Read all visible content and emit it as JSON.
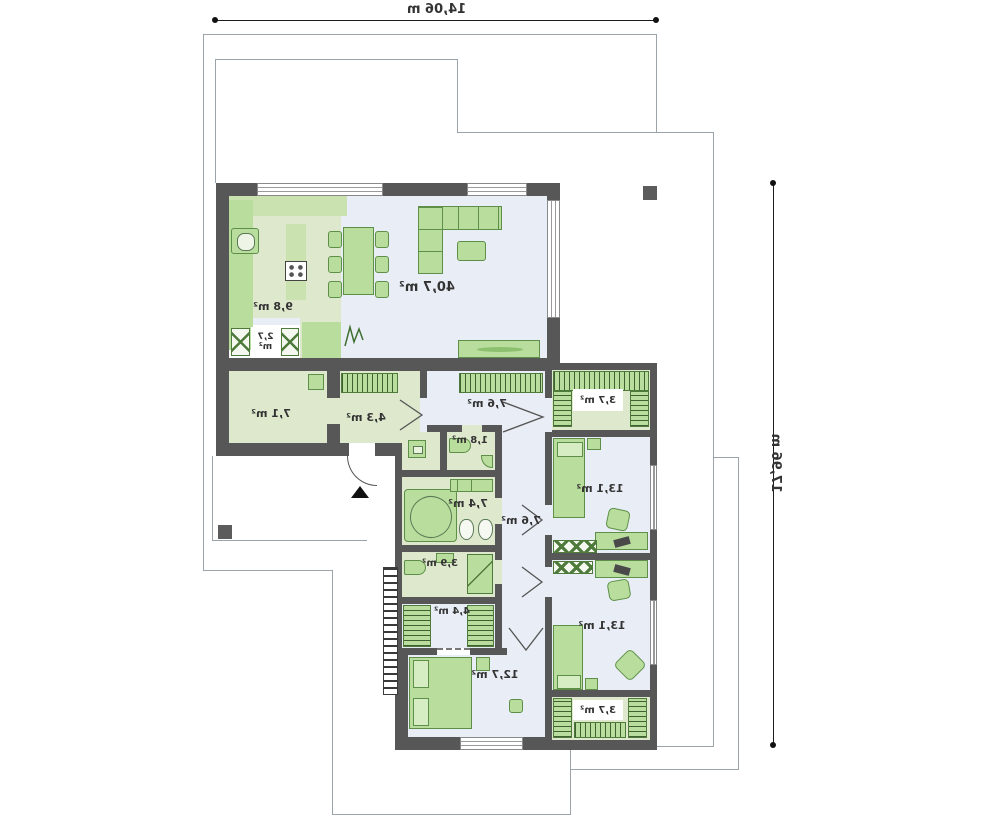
{
  "plan": {
    "title": "single-storey house floor plan (mirrored print)",
    "dimensions": {
      "width": "14,06 m",
      "height": "17,96 m"
    },
    "rooms": [
      {
        "name": "living-room",
        "area": "40,7 m²"
      },
      {
        "name": "kitchen",
        "area": "9,8 m²"
      },
      {
        "name": "pantry",
        "value": "2,7",
        "unit": "m²"
      },
      {
        "name": "utility-room",
        "area": "7,1 m²"
      },
      {
        "name": "hall",
        "area": "4,3 m²"
      },
      {
        "name": "corridor-upper",
        "area": "7,6 m²"
      },
      {
        "name": "wc",
        "area": "1,8 m²"
      },
      {
        "name": "bathroom",
        "area": "7,4 m²"
      },
      {
        "name": "corridor-lower",
        "area": "7,6 m²"
      },
      {
        "name": "shower-room",
        "area": "3,9 m²"
      },
      {
        "name": "wardrobe-hall",
        "area": "4,4 m²"
      },
      {
        "name": "bedroom-master",
        "area": "12,7 m²"
      },
      {
        "name": "wardrobe-north",
        "area": "3,7 m²"
      },
      {
        "name": "bedroom-north",
        "area": "13,1 m²"
      },
      {
        "name": "bedroom-south",
        "area": "13,1 m²"
      },
      {
        "name": "wardrobe-south",
        "area": "3,7 m²"
      }
    ],
    "colors": {
      "wall": "#575757",
      "floor_blue": "#e9eef6",
      "floor_green": "#dde8cd",
      "furniture": "#b9dd9c",
      "furniture_border": "#5d8f48",
      "plot_line": "#9aa3a8",
      "dimension_line": "#1c1c1c"
    }
  }
}
